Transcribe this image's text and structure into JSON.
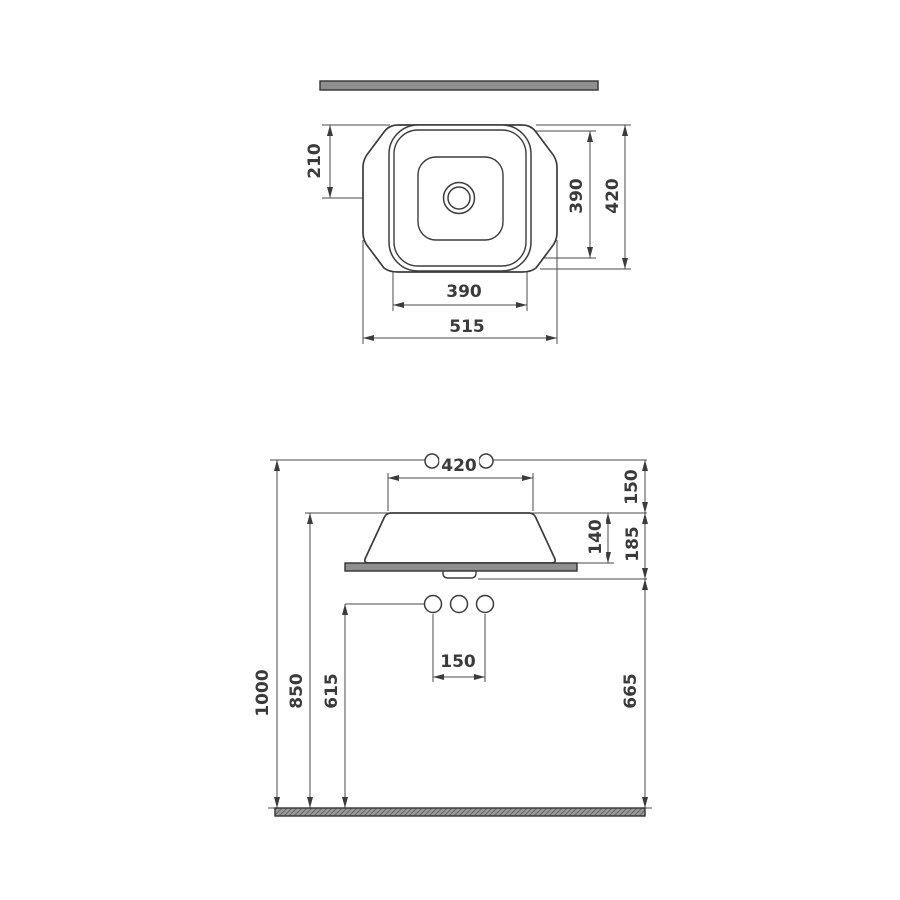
{
  "title": "Countertop washbasin technical drawing",
  "colors": {
    "background": "#ffffff",
    "line": "#3c3c3c",
    "gray_fill": "#8f8f8f",
    "text": "#3a3a3a"
  },
  "top_view": {
    "dim_drain_center_from_top": "210",
    "dim_inner_depth": "390",
    "dim_overall_depth": "420",
    "dim_inner_width": "390",
    "dim_overall_width": "515"
  },
  "side_view": {
    "dim_basin_top_width": "420",
    "dim_top_to_rim": "150",
    "dim_basin_above_counter": "140",
    "dim_rim_to_counter_bottom": "185",
    "dim_overall_height": "1000",
    "dim_counter_height": "850",
    "dim_supply_height": "615",
    "dim_under_counter_height": "665",
    "dim_hole_spacing": "150"
  }
}
